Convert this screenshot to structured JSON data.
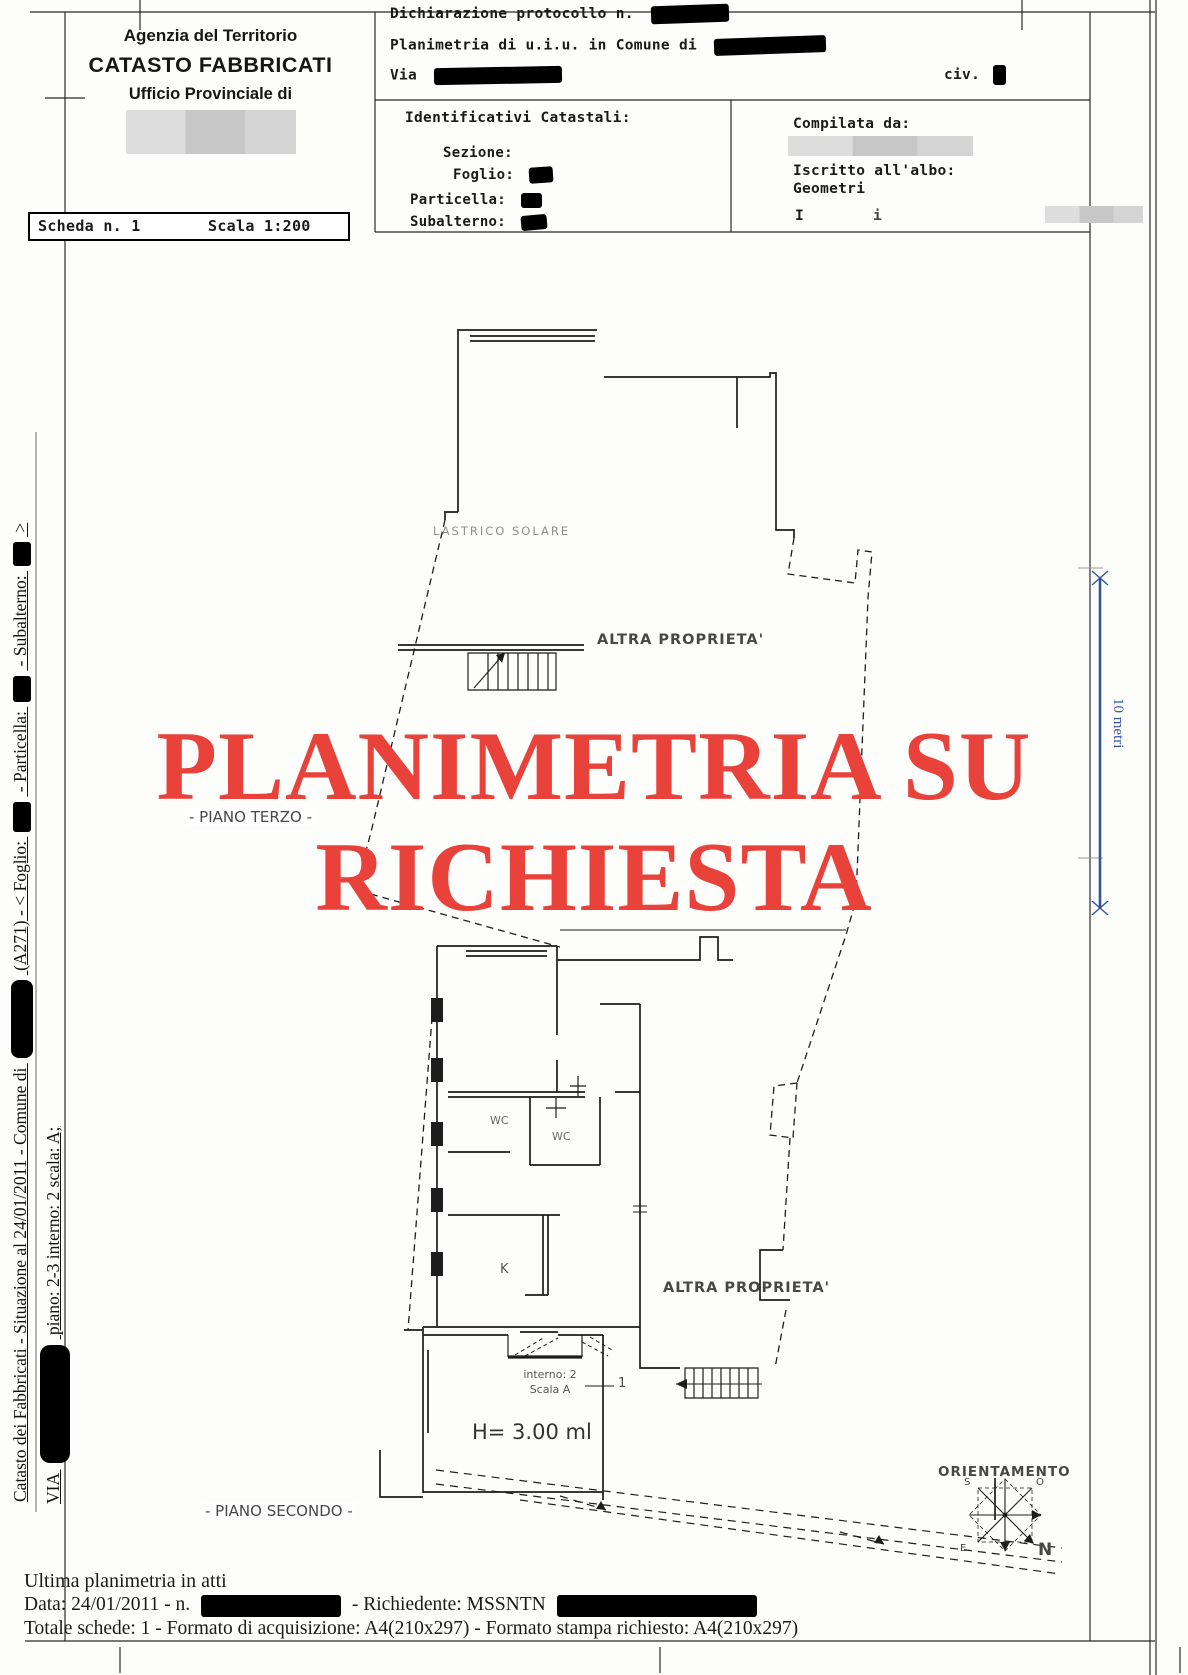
{
  "header": {
    "agency_line1": "Agenzia del Territorio",
    "agency_line2": "CATASTO FABBRICATI",
    "agency_line3": "Ufficio Provinciale di",
    "scheda_label": "Scheda n. 1",
    "scala_label": "Scala 1:200",
    "protocol_label": "Dichiarazione protocollo n.",
    "planimetria_label": "Planimetria di u.i.u. in Comune di",
    "via_label": "Via",
    "civ_label": "civ.",
    "identificativi": {
      "title": "Identificativi Catastali:",
      "sezione": "Sezione:",
      "foglio": "Foglio:",
      "particella": "Particella:",
      "subalterno": "Subalterno:"
    },
    "compilata": {
      "title": "Compilata da:",
      "albo_label": "Iscritto all'albo:",
      "albo_value": "Geometri",
      "partial_left": "I",
      "partial_right": "i"
    }
  },
  "stamp": {
    "line1": "PLANIMETRIA SU",
    "line2": "RICHIESTA",
    "color": "#e8423a"
  },
  "plan": {
    "lastrico": "LASTRICO SOLARE",
    "altra_proprieta_top": "ALTRA PROPRIETA'",
    "piano_terzo": "- PIANO TERZO -",
    "wc1": "WC",
    "wc2": "WC",
    "kitchen": "K",
    "altra_proprieta_bottom": "ALTRA PROPRIETA'",
    "interno_line1": "interno: 2",
    "interno_line2": "Scala A",
    "interno_mark": "1",
    "height_label": "H= 3.00 ml",
    "piano_secondo": "- PIANO SECONDO -",
    "orientamento": "ORIENTAMENTO",
    "compass": {
      "n": "N",
      "s": "S",
      "e": "E",
      "o": "O"
    }
  },
  "scalebar": {
    "label": "10 metri",
    "color": "#33519e"
  },
  "sidebar": {
    "l1a": "Catasto dei Fabbricati - Situazione al 24/01/2011 - Comune di",
    "l1b": "(A271) - < Foglio:",
    "l1c": "- Particella:",
    "l1d": "- Subalterno:",
    "l1e": ">",
    "l2a": "VIA",
    "l2b": "piano: 2-3 interno: 2 scala: A;"
  },
  "footer": {
    "ultima": "Ultima planimetria in atti",
    "data_a": "Data: 24/01/2011 - n.",
    "data_b": "- Richiedente: MSSNTN",
    "totale": "Totale schede: 1 - Formato di acquisizione: A4(210x297) - Formato stampa richiesto: A4(210x297)"
  }
}
